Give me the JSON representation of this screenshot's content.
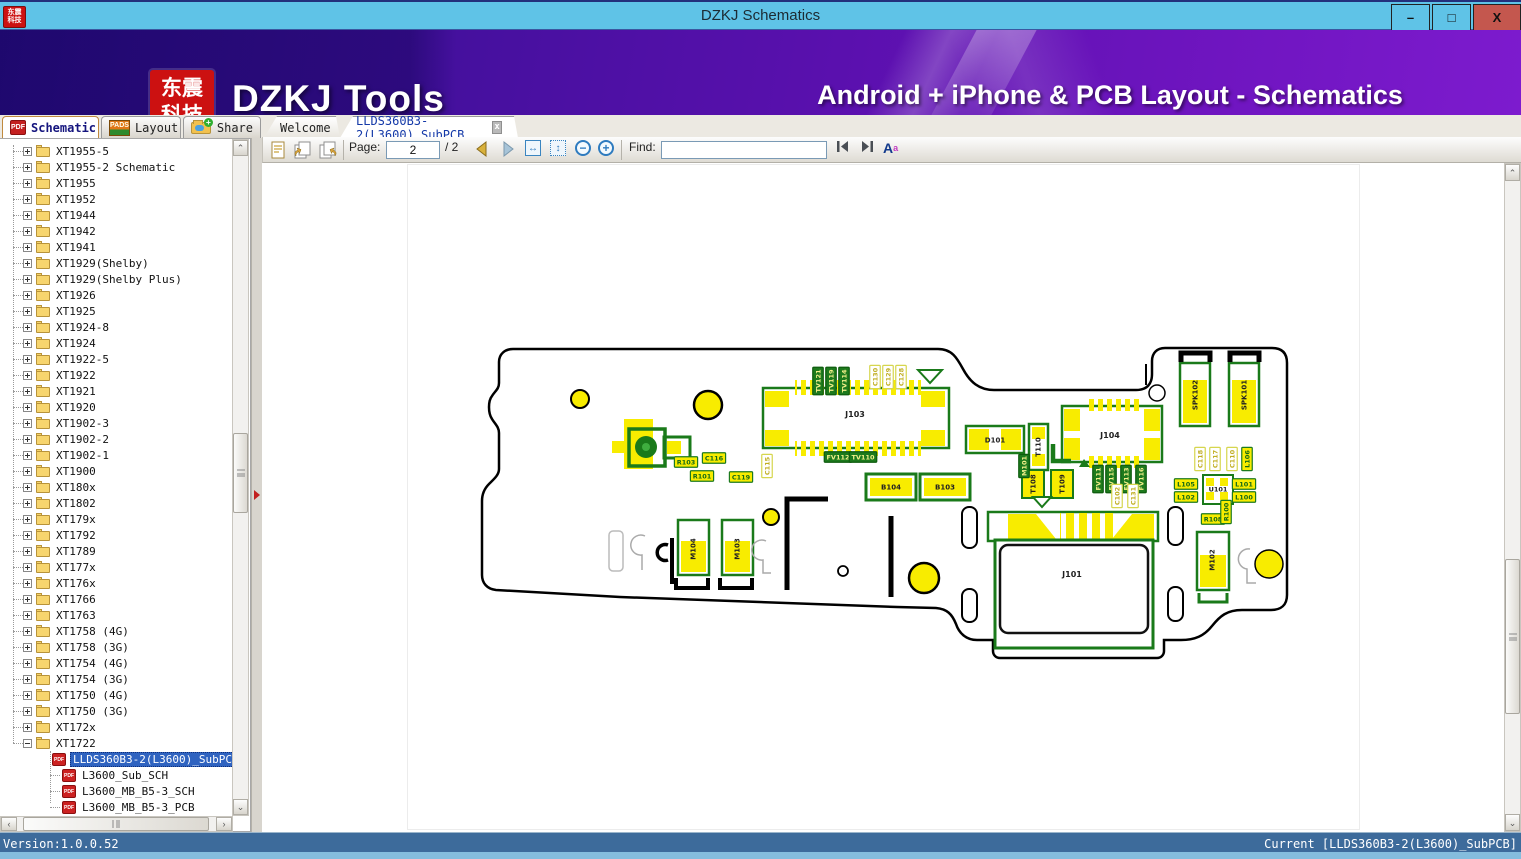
{
  "window": {
    "title": "DZKJ Schematics",
    "controls": {
      "minimize": "–",
      "maximize": "□",
      "close": "X"
    }
  },
  "banner": {
    "logo_line1": "东震",
    "logo_line2": "科技",
    "brand": "DZKJ Tools",
    "tagline": "Android + iPhone & PCB Layout - Schematics"
  },
  "icons": {
    "pdf_badge": "PDF",
    "pads_badge": "PADS"
  },
  "tabs": {
    "tool_tabs": [
      {
        "label": "Schematic",
        "icon": "pdf-icon",
        "active": true
      },
      {
        "label": "Layout",
        "icon": "pads-icon",
        "active": false
      },
      {
        "label": "Share",
        "icon": "share-folder-icon",
        "active": false
      }
    ],
    "doc_tabs": [
      {
        "label": "Welcome",
        "active": false
      },
      {
        "label": "LLDS360B3-2(L3600)_SubPCB",
        "active": true,
        "closable": true
      }
    ]
  },
  "toolbar": {
    "page_label": "Page:",
    "page_value": "2",
    "page_total": "/ 2",
    "find_label": "Find:",
    "find_value": ""
  },
  "sidebar": {
    "items": [
      {
        "l": "XT1955-5",
        "t": "folder"
      },
      {
        "l": "XT1955-2 Schematic",
        "t": "folder"
      },
      {
        "l": "XT1955",
        "t": "folder"
      },
      {
        "l": "XT1952",
        "t": "folder"
      },
      {
        "l": "XT1944",
        "t": "folder"
      },
      {
        "l": "XT1942",
        "t": "folder"
      },
      {
        "l": "XT1941",
        "t": "folder"
      },
      {
        "l": "XT1929(Shelby)",
        "t": "folder"
      },
      {
        "l": "XT1929(Shelby Plus)",
        "t": "folder"
      },
      {
        "l": "XT1926",
        "t": "folder"
      },
      {
        "l": "XT1925",
        "t": "folder"
      },
      {
        "l": "XT1924-8",
        "t": "folder"
      },
      {
        "l": "XT1924",
        "t": "folder"
      },
      {
        "l": "XT1922-5",
        "t": "folder"
      },
      {
        "l": "XT1922",
        "t": "folder"
      },
      {
        "l": "XT1921",
        "t": "folder"
      },
      {
        "l": "XT1920",
        "t": "folder"
      },
      {
        "l": "XT1902-3",
        "t": "folder"
      },
      {
        "l": "XT1902-2",
        "t": "folder"
      },
      {
        "l": "XT1902-1",
        "t": "folder"
      },
      {
        "l": "XT1900",
        "t": "folder"
      },
      {
        "l": "XT180x",
        "t": "folder"
      },
      {
        "l": "XT1802",
        "t": "folder"
      },
      {
        "l": "XT179x",
        "t": "folder"
      },
      {
        "l": "XT1792",
        "t": "folder"
      },
      {
        "l": "XT1789",
        "t": "folder"
      },
      {
        "l": "XT177x",
        "t": "folder"
      },
      {
        "l": "XT176x",
        "t": "folder"
      },
      {
        "l": "XT1766",
        "t": "folder"
      },
      {
        "l": "XT1763",
        "t": "folder"
      },
      {
        "l": "XT1758 (4G)",
        "t": "folder"
      },
      {
        "l": "XT1758 (3G)",
        "t": "folder"
      },
      {
        "l": "XT1754 (4G)",
        "t": "folder"
      },
      {
        "l": "XT1754 (3G)",
        "t": "folder"
      },
      {
        "l": "XT1750 (4G)",
        "t": "folder"
      },
      {
        "l": "XT1750 (3G)",
        "t": "folder"
      },
      {
        "l": "XT172x",
        "t": "folder"
      },
      {
        "l": "XT1722",
        "t": "folder",
        "e": true
      },
      {
        "l": "LLDS360B3-2(L3600)_SubPCB",
        "t": "pdf",
        "sel": true
      },
      {
        "l": "L3600_Sub_SCH",
        "t": "pdf"
      },
      {
        "l": "L3600_MB_B5-3_SCH",
        "t": "pdf"
      },
      {
        "l": "L3600_MB_B5-3_PCB",
        "t": "pdf"
      }
    ]
  },
  "viewer": {
    "pcb_labels": [
      {
        "t": "TV121",
        "x": 818,
        "y": 381,
        "o": "v",
        "s": "g"
      },
      {
        "t": "TV119",
        "x": 831,
        "y": 381,
        "o": "v",
        "s": "g"
      },
      {
        "t": "TV114",
        "x": 844,
        "y": 381,
        "o": "v",
        "s": "g"
      },
      {
        "t": "C130",
        "x": 875,
        "y": 377,
        "o": "v",
        "s": "o"
      },
      {
        "t": "C129",
        "x": 888,
        "y": 377,
        "o": "v",
        "s": "o"
      },
      {
        "t": "C128",
        "x": 901,
        "y": 377,
        "o": "v",
        "s": "o"
      },
      {
        "t": "FV112",
        "x": 838,
        "y": 457,
        "o": "h",
        "s": "g"
      },
      {
        "t": "TV110",
        "x": 863,
        "y": 457,
        "o": "h",
        "s": "g"
      },
      {
        "t": "R103",
        "x": 686,
        "y": 462,
        "o": "h",
        "s": "y"
      },
      {
        "t": "C116",
        "x": 714,
        "y": 458,
        "o": "h",
        "s": "y"
      },
      {
        "t": "R101",
        "x": 702,
        "y": 476,
        "o": "h",
        "s": "y"
      },
      {
        "t": "C115",
        "x": 767,
        "y": 466,
        "o": "v",
        "s": "o"
      },
      {
        "t": "C119",
        "x": 741,
        "y": 477,
        "o": "h",
        "s": "y"
      },
      {
        "t": "J103",
        "x": 855,
        "y": 414,
        "o": "h",
        "s": "p",
        "f": 8
      },
      {
        "t": "J104",
        "x": 1110,
        "y": 435,
        "o": "h",
        "s": "p",
        "f": 8
      },
      {
        "t": "J101",
        "x": 1072,
        "y": 574,
        "o": "h",
        "s": "p",
        "f": 8
      },
      {
        "t": "D101",
        "x": 995,
        "y": 440,
        "o": "h",
        "s": "p",
        "f": 7
      },
      {
        "t": "T110",
        "x": 1038,
        "y": 447,
        "o": "v",
        "s": "p",
        "f": 7
      },
      {
        "t": "M101",
        "x": 1024,
        "y": 466,
        "o": "v",
        "s": "g"
      },
      {
        "t": "T108",
        "x": 1033,
        "y": 484,
        "o": "v",
        "s": "p",
        "f": 7
      },
      {
        "t": "T109",
        "x": 1062,
        "y": 484,
        "o": "v",
        "s": "p",
        "f": 7
      },
      {
        "t": "FV111",
        "x": 1098,
        "y": 479,
        "o": "v",
        "s": "g"
      },
      {
        "t": "FV115",
        "x": 1111,
        "y": 479,
        "o": "v",
        "s": "g"
      },
      {
        "t": "FV113",
        "x": 1126,
        "y": 479,
        "o": "v",
        "s": "g"
      },
      {
        "t": "FV116",
        "x": 1141,
        "y": 479,
        "o": "v",
        "s": "g"
      },
      {
        "t": "C102",
        "x": 1117,
        "y": 496,
        "o": "v",
        "s": "o"
      },
      {
        "t": "C131",
        "x": 1133,
        "y": 496,
        "o": "v",
        "s": "o"
      },
      {
        "t": "B104",
        "x": 891,
        "y": 487,
        "o": "h",
        "s": "p",
        "f": 7
      },
      {
        "t": "B103",
        "x": 945,
        "y": 487,
        "o": "h",
        "s": "p",
        "f": 7
      },
      {
        "t": "SPK102",
        "x": 1195,
        "y": 395,
        "o": "v",
        "s": "p",
        "f": 7
      },
      {
        "t": "SPK101",
        "x": 1244,
        "y": 395,
        "o": "v",
        "s": "p",
        "f": 7
      },
      {
        "t": "C118",
        "x": 1200,
        "y": 459,
        "o": "v",
        "s": "o"
      },
      {
        "t": "C117",
        "x": 1215,
        "y": 459,
        "o": "v",
        "s": "o"
      },
      {
        "t": "C110",
        "x": 1232,
        "y": 459,
        "o": "v",
        "s": "o"
      },
      {
        "t": "L106",
        "x": 1247,
        "y": 459,
        "o": "v",
        "s": "y"
      },
      {
        "t": "L105",
        "x": 1186,
        "y": 484,
        "o": "h",
        "s": "y"
      },
      {
        "t": "L102",
        "x": 1186,
        "y": 497,
        "o": "h",
        "s": "y"
      },
      {
        "t": "U101",
        "x": 1218,
        "y": 489,
        "o": "h",
        "s": "p",
        "f": 6.5
      },
      {
        "t": "L101",
        "x": 1244,
        "y": 484,
        "o": "h",
        "s": "y"
      },
      {
        "t": "L100",
        "x": 1244,
        "y": 497,
        "o": "h",
        "s": "y"
      },
      {
        "t": "R108",
        "x": 1213,
        "y": 519,
        "o": "h",
        "s": "y"
      },
      {
        "t": "R100",
        "x": 1226,
        "y": 512,
        "o": "v",
        "s": "y"
      },
      {
        "t": "M104",
        "x": 693,
        "y": 549,
        "o": "v",
        "s": "p",
        "f": 7
      },
      {
        "t": "M103",
        "x": 737,
        "y": 549,
        "o": "v",
        "s": "p",
        "f": 7
      },
      {
        "t": "M102",
        "x": 1212,
        "y": 560,
        "o": "v",
        "s": "p",
        "f": 7
      }
    ]
  },
  "statusbar": {
    "version": "Version:1.0.0.52",
    "current": "Current [LLDS360B3-2(L3600)_SubPCB]"
  },
  "colors": {
    "c-titlebar": "#5fc3e7",
    "c-close": "#c4574e",
    "c-logo": "#cc1111",
    "c-banner1": "#45109e",
    "c-banner2": "#7d1bce",
    "c-select": "#2f63c0",
    "c-status": "#3d6b9b",
    "c-pcb-yellow": "#f8ec00",
    "c-pcb-green": "#1a7a1a"
  }
}
